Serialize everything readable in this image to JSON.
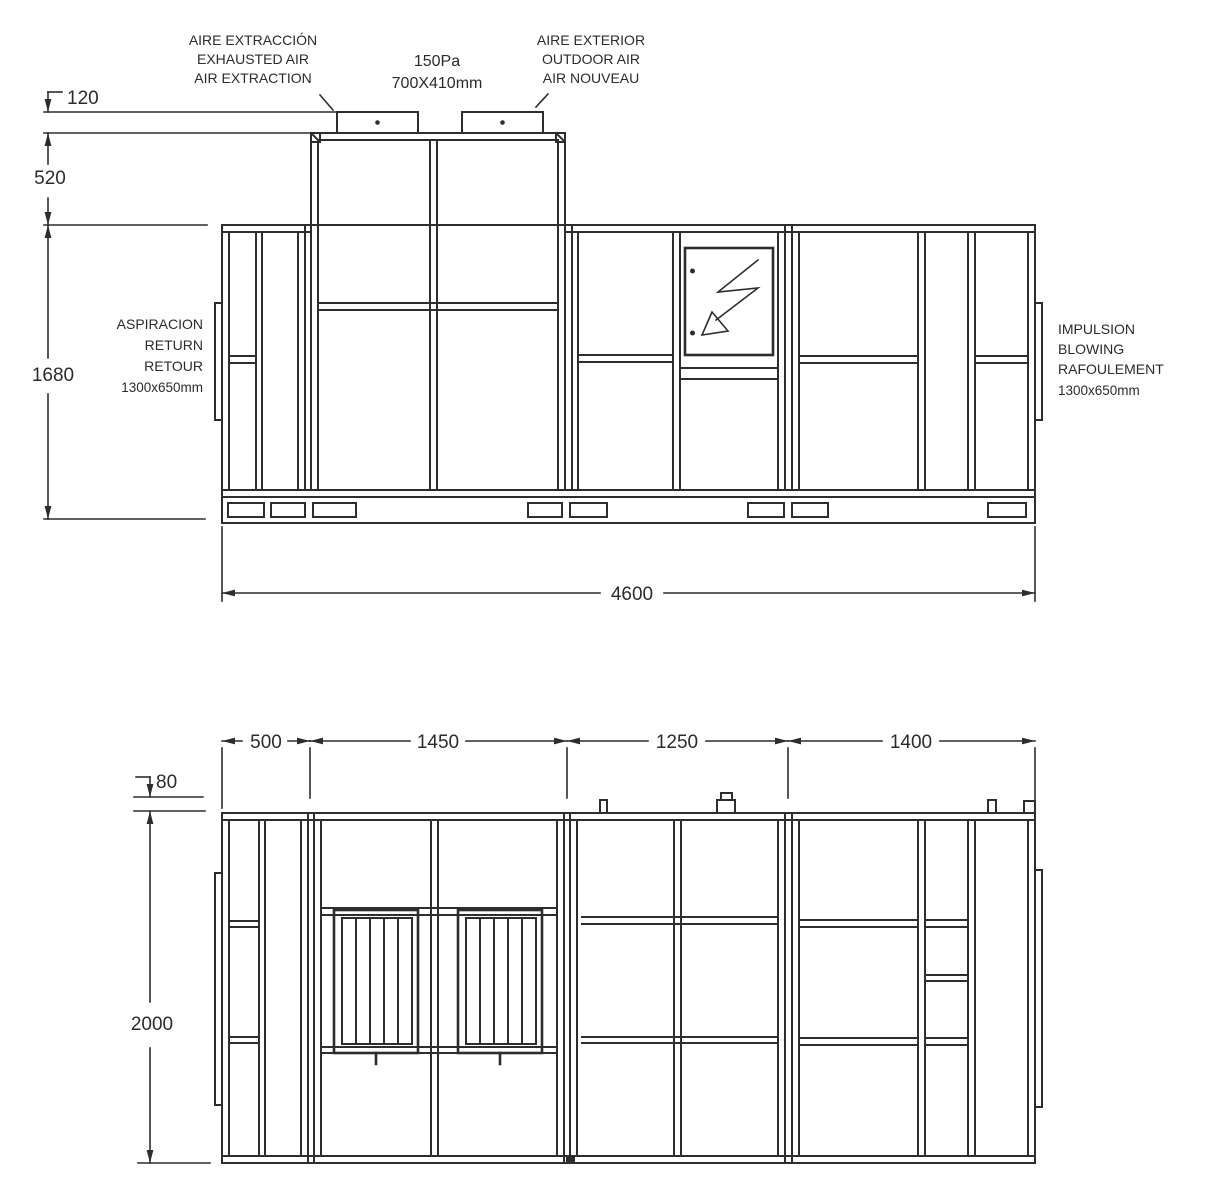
{
  "top_view": {
    "labels": {
      "exhaust": [
        "AIRE EXTRACCIÓN",
        "EXHAUSTED AIR",
        "AIR EXTRACTION"
      ],
      "duct_spec": [
        "150Pa",
        "700X410mm"
      ],
      "outdoor": [
        "AIRE EXTERIOR",
        "OUTDOOR AIR",
        "AIR NOUVEAU"
      ],
      "return_port": [
        "ASPIRACION",
        "RETURN",
        "RETOUR",
        "1300x650mm"
      ],
      "supply_port": [
        "IMPULSION",
        "BLOWING",
        "RAFOULEMENT",
        "1300x650mm"
      ]
    },
    "dimensions": {
      "duct_collar_height": "120",
      "plenum_height": "520",
      "body_height": "1680",
      "overall_length": "4600"
    }
  },
  "bottom_view": {
    "dimensions": {
      "section1": "500",
      "section2": "1450",
      "section3": "1250",
      "section4": "1400",
      "base_height": "80",
      "overall_height": "2000"
    }
  }
}
